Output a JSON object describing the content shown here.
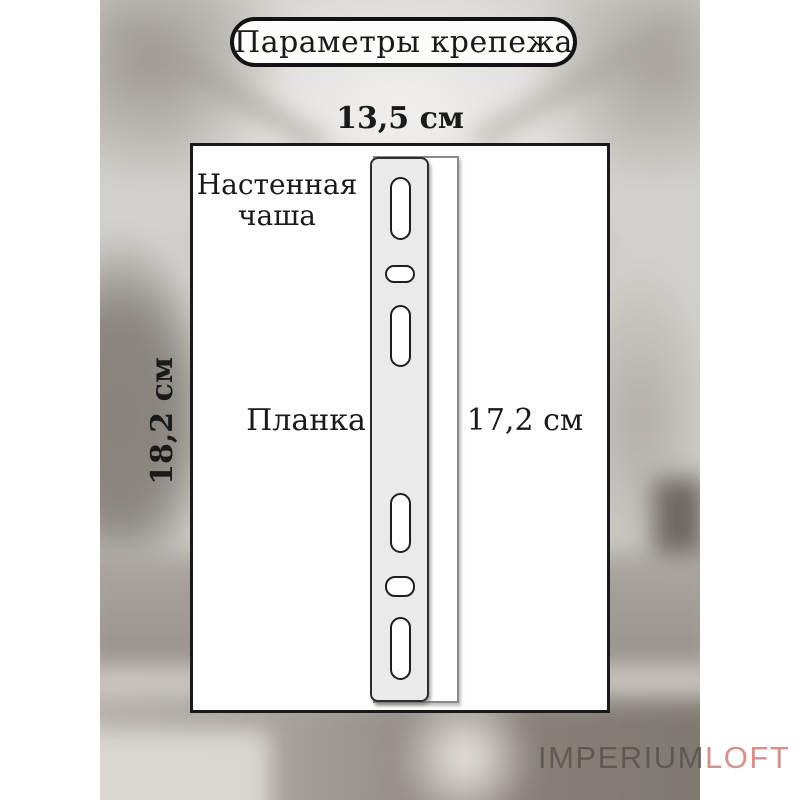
{
  "title": "Параметры крепежа",
  "diagram": {
    "top_dimension": "13,5 см",
    "left_dimension": "18,2 см",
    "right_dimension": "17,2 см",
    "wall_cup_label": "Настенная чаша",
    "plate_label": "Планка"
  },
  "watermark": {
    "brand_part1": "IMPERIUM",
    "brand_part2": "LOFT"
  },
  "colors": {
    "outline_black": "#191919",
    "plate_fill": "#eaeaea",
    "cup_outline_gray": "#8a8a8a",
    "watermark_gray": "#5a5552",
    "watermark_accent": "#d4928e"
  }
}
